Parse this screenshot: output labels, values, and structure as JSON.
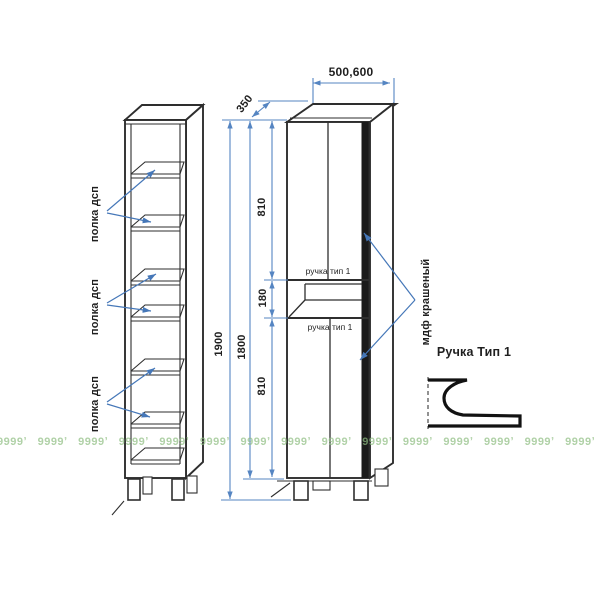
{
  "drawing": {
    "dims": {
      "width": "500,600",
      "depth": "350",
      "height_total": "1900",
      "height_body": "1800",
      "upper_door": "810",
      "drawer": "180",
      "lower_door": "810"
    },
    "shelf_labels": [
      "полка дсп",
      "полка дсп",
      "полка дсп"
    ],
    "handle_labels": [
      "ручка тип 1",
      "ручка тип 1"
    ],
    "material_label": "мдф крашеный",
    "handle_detail_title": "Ручка Тип 1",
    "watermark": {
      "unit": "9999ʼ",
      "count": 21
    },
    "colors": {
      "dim_blue": "#5585c2",
      "callout_blue": "#4577b8",
      "line_dark": "#2e2e2e",
      "watermark_green": "#8fbe82"
    }
  }
}
